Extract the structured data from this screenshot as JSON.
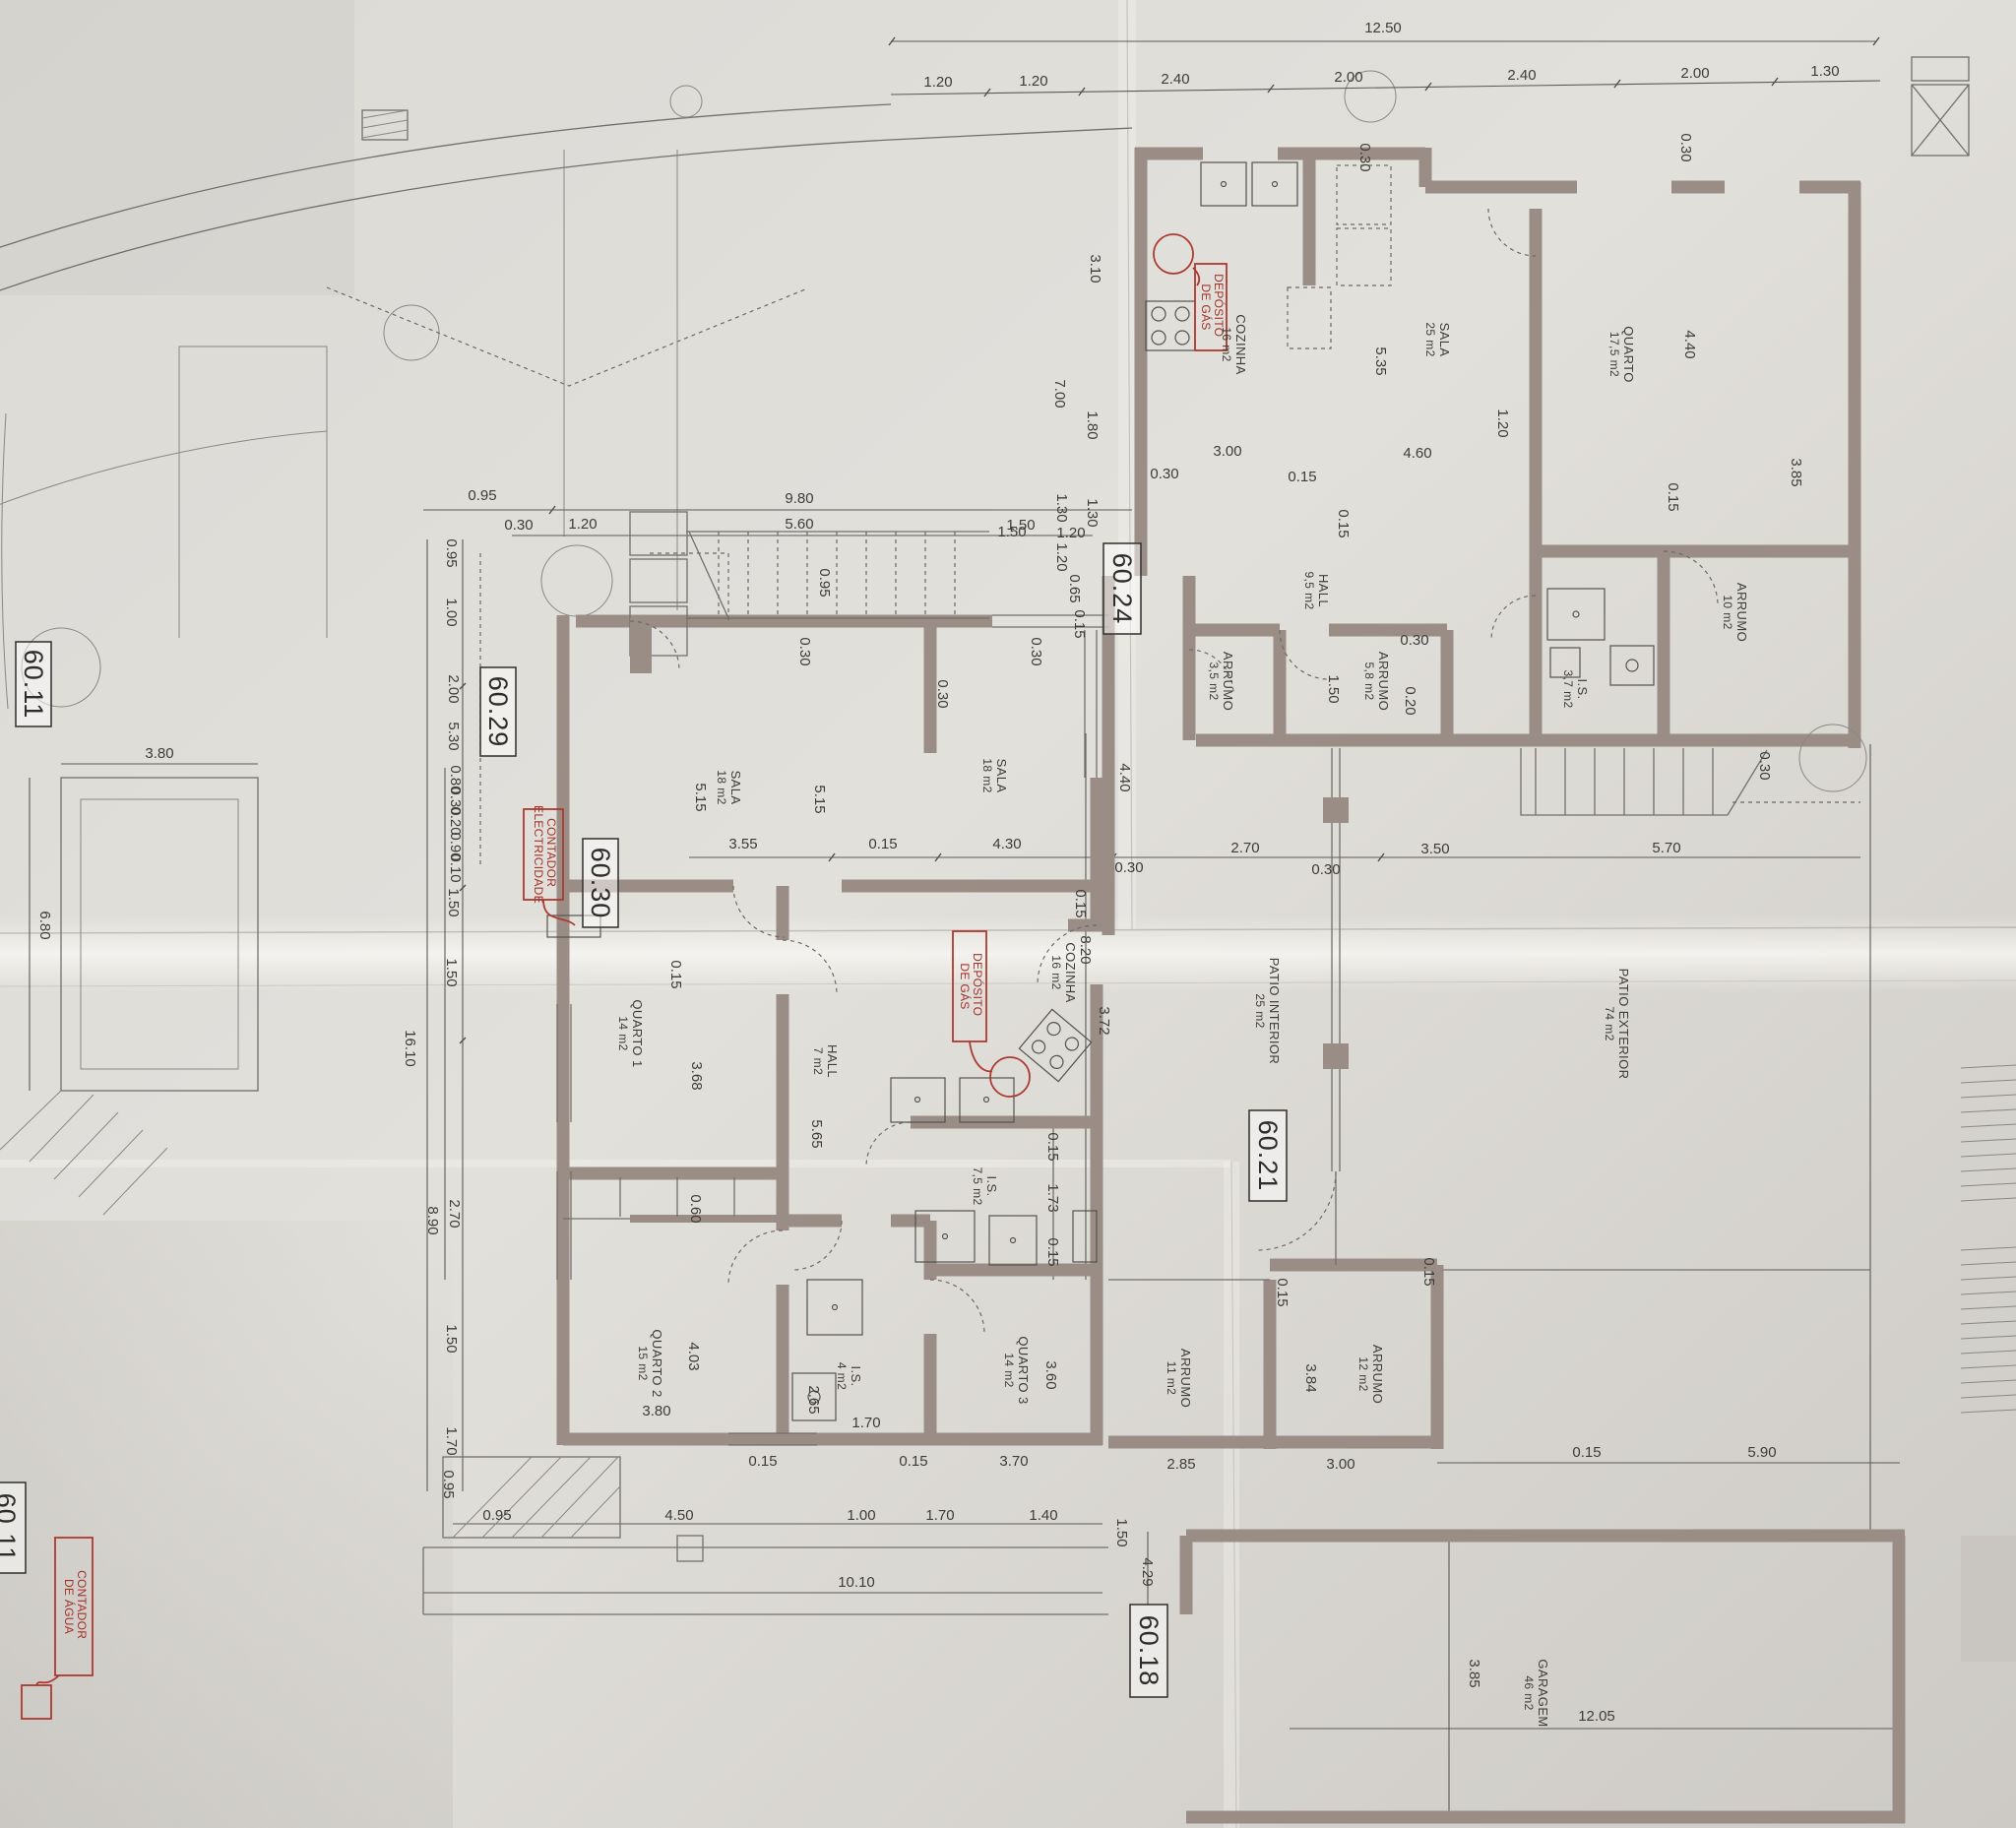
{
  "levels": [
    {
      "text": "60.24"
    },
    {
      "text": "60.29"
    },
    {
      "text": "60.30"
    },
    {
      "text": "60.11"
    },
    {
      "text": "60.21"
    },
    {
      "text": "60.18"
    },
    {
      "text": "60.11"
    }
  ],
  "utility": {
    "gas1_l1": "DEPÓSITO",
    "gas1_l2": "DE GÁS",
    "gas2_l1": "DEPÓSITO",
    "gas2_l2": "DE GÁS",
    "elec_l1": "CONTADOR",
    "elec_l2": "ELECTRICIDADE",
    "water_l1": "CONTADOR",
    "water_l2": "DE ÁGUA"
  },
  "rooms": [
    {
      "n": "COZINHA",
      "a": "16 m2"
    },
    {
      "n": "SALA",
      "a": "25 m2"
    },
    {
      "n": "QUARTO",
      "a": "17,5 m2"
    },
    {
      "n": "HALL",
      "a": "9,5 m2"
    },
    {
      "n": "ARRUMO",
      "a": "3,5 m2"
    },
    {
      "n": "ARRUMO",
      "a": "5,8 m2"
    },
    {
      "n": "I.S.",
      "a": "3,7 m2"
    },
    {
      "n": "ARRUMO",
      "a": "10 m2"
    },
    {
      "n": "SALA",
      "a": "18 m2"
    },
    {
      "n": "SALA",
      "a": "18 m2"
    },
    {
      "n": "QUARTO 1",
      "a": "14 m2"
    },
    {
      "n": "HALL",
      "a": "7 m2"
    },
    {
      "n": "COZINHA",
      "a": "16 m2"
    },
    {
      "n": "I.S.",
      "a": "7,5 m2"
    },
    {
      "n": "QUARTO 2",
      "a": "15 m2"
    },
    {
      "n": "I.S.",
      "a": "4 m2"
    },
    {
      "n": "QUARTO 3",
      "a": "14 m2"
    },
    {
      "n": "ARRUMO",
      "a": "11 m2"
    },
    {
      "n": "ARRUMO",
      "a": "12 m2"
    },
    {
      "n": "PATIO INTERIOR",
      "a": "25 m2"
    },
    {
      "n": "PATIO EXTERIOR",
      "a": "74 m2"
    },
    {
      "n": "GARAGEM",
      "a": "46 m2"
    }
  ],
  "dims": {
    "t": [
      "12.50",
      "1.20",
      "1.20",
      "2.40",
      "2.00",
      "2.40",
      "2.00",
      "1.30"
    ],
    "uh": [
      "0.30",
      "3.10",
      "7.00",
      "1.80",
      "5.35",
      "4.40",
      "0.30",
      "3.85",
      "3.00",
      "0.30",
      "0.15",
      "4.60",
      "0.15",
      "1.20",
      "0.15",
      "1.50",
      "0.20",
      "0.30"
    ],
    "g24": [
      "1.30",
      "0.65",
      "0.15",
      "0.30",
      "1.50",
      "1.20"
    ],
    "mid": [
      "3.55",
      "0.15",
      "4.30",
      "0.30",
      "2.70",
      "0.30",
      "3.50",
      "5.70"
    ],
    "corr": [
      "4.40",
      "0.15",
      "3.72"
    ],
    "patio": [
      "8.20",
      "0.30"
    ],
    "lht": [
      "0.95",
      "9.80",
      "0.30",
      "1.20",
      "5.60",
      "1.50",
      "1.30",
      "1.20",
      "0.95",
      "0.30"
    ],
    "lc": [
      "0.95",
      "1.00",
      "2.00",
      "5.30",
      "0.80",
      "0.30",
      "0.20",
      "0.90",
      "0.10",
      "1.50",
      "1.50",
      "2.70",
      "1.50",
      "1.70",
      "0.95",
      "16.10",
      "8.90"
    ],
    "lhi": [
      "5.15",
      "5.15",
      "0.30",
      "0.15",
      "3.68",
      "5.65",
      "0.60",
      "4.03",
      "3.80",
      "2.65",
      "1.70",
      "0.15",
      "0.15",
      "3.70",
      "3.60",
      "1.73",
      "0.15",
      "0.15"
    ],
    "ar": [
      "0.15",
      "3.84",
      "3.00",
      "2.85",
      "0.15",
      "5.90",
      "0.15",
      "3.85",
      "12.05",
      "4.29",
      "1.50"
    ],
    "bot": [
      "0.95",
      "4.50",
      "1.00",
      "1.70",
      "1.40",
      "10.10"
    ],
    "site": [
      "3.80",
      "6.80"
    ]
  }
}
